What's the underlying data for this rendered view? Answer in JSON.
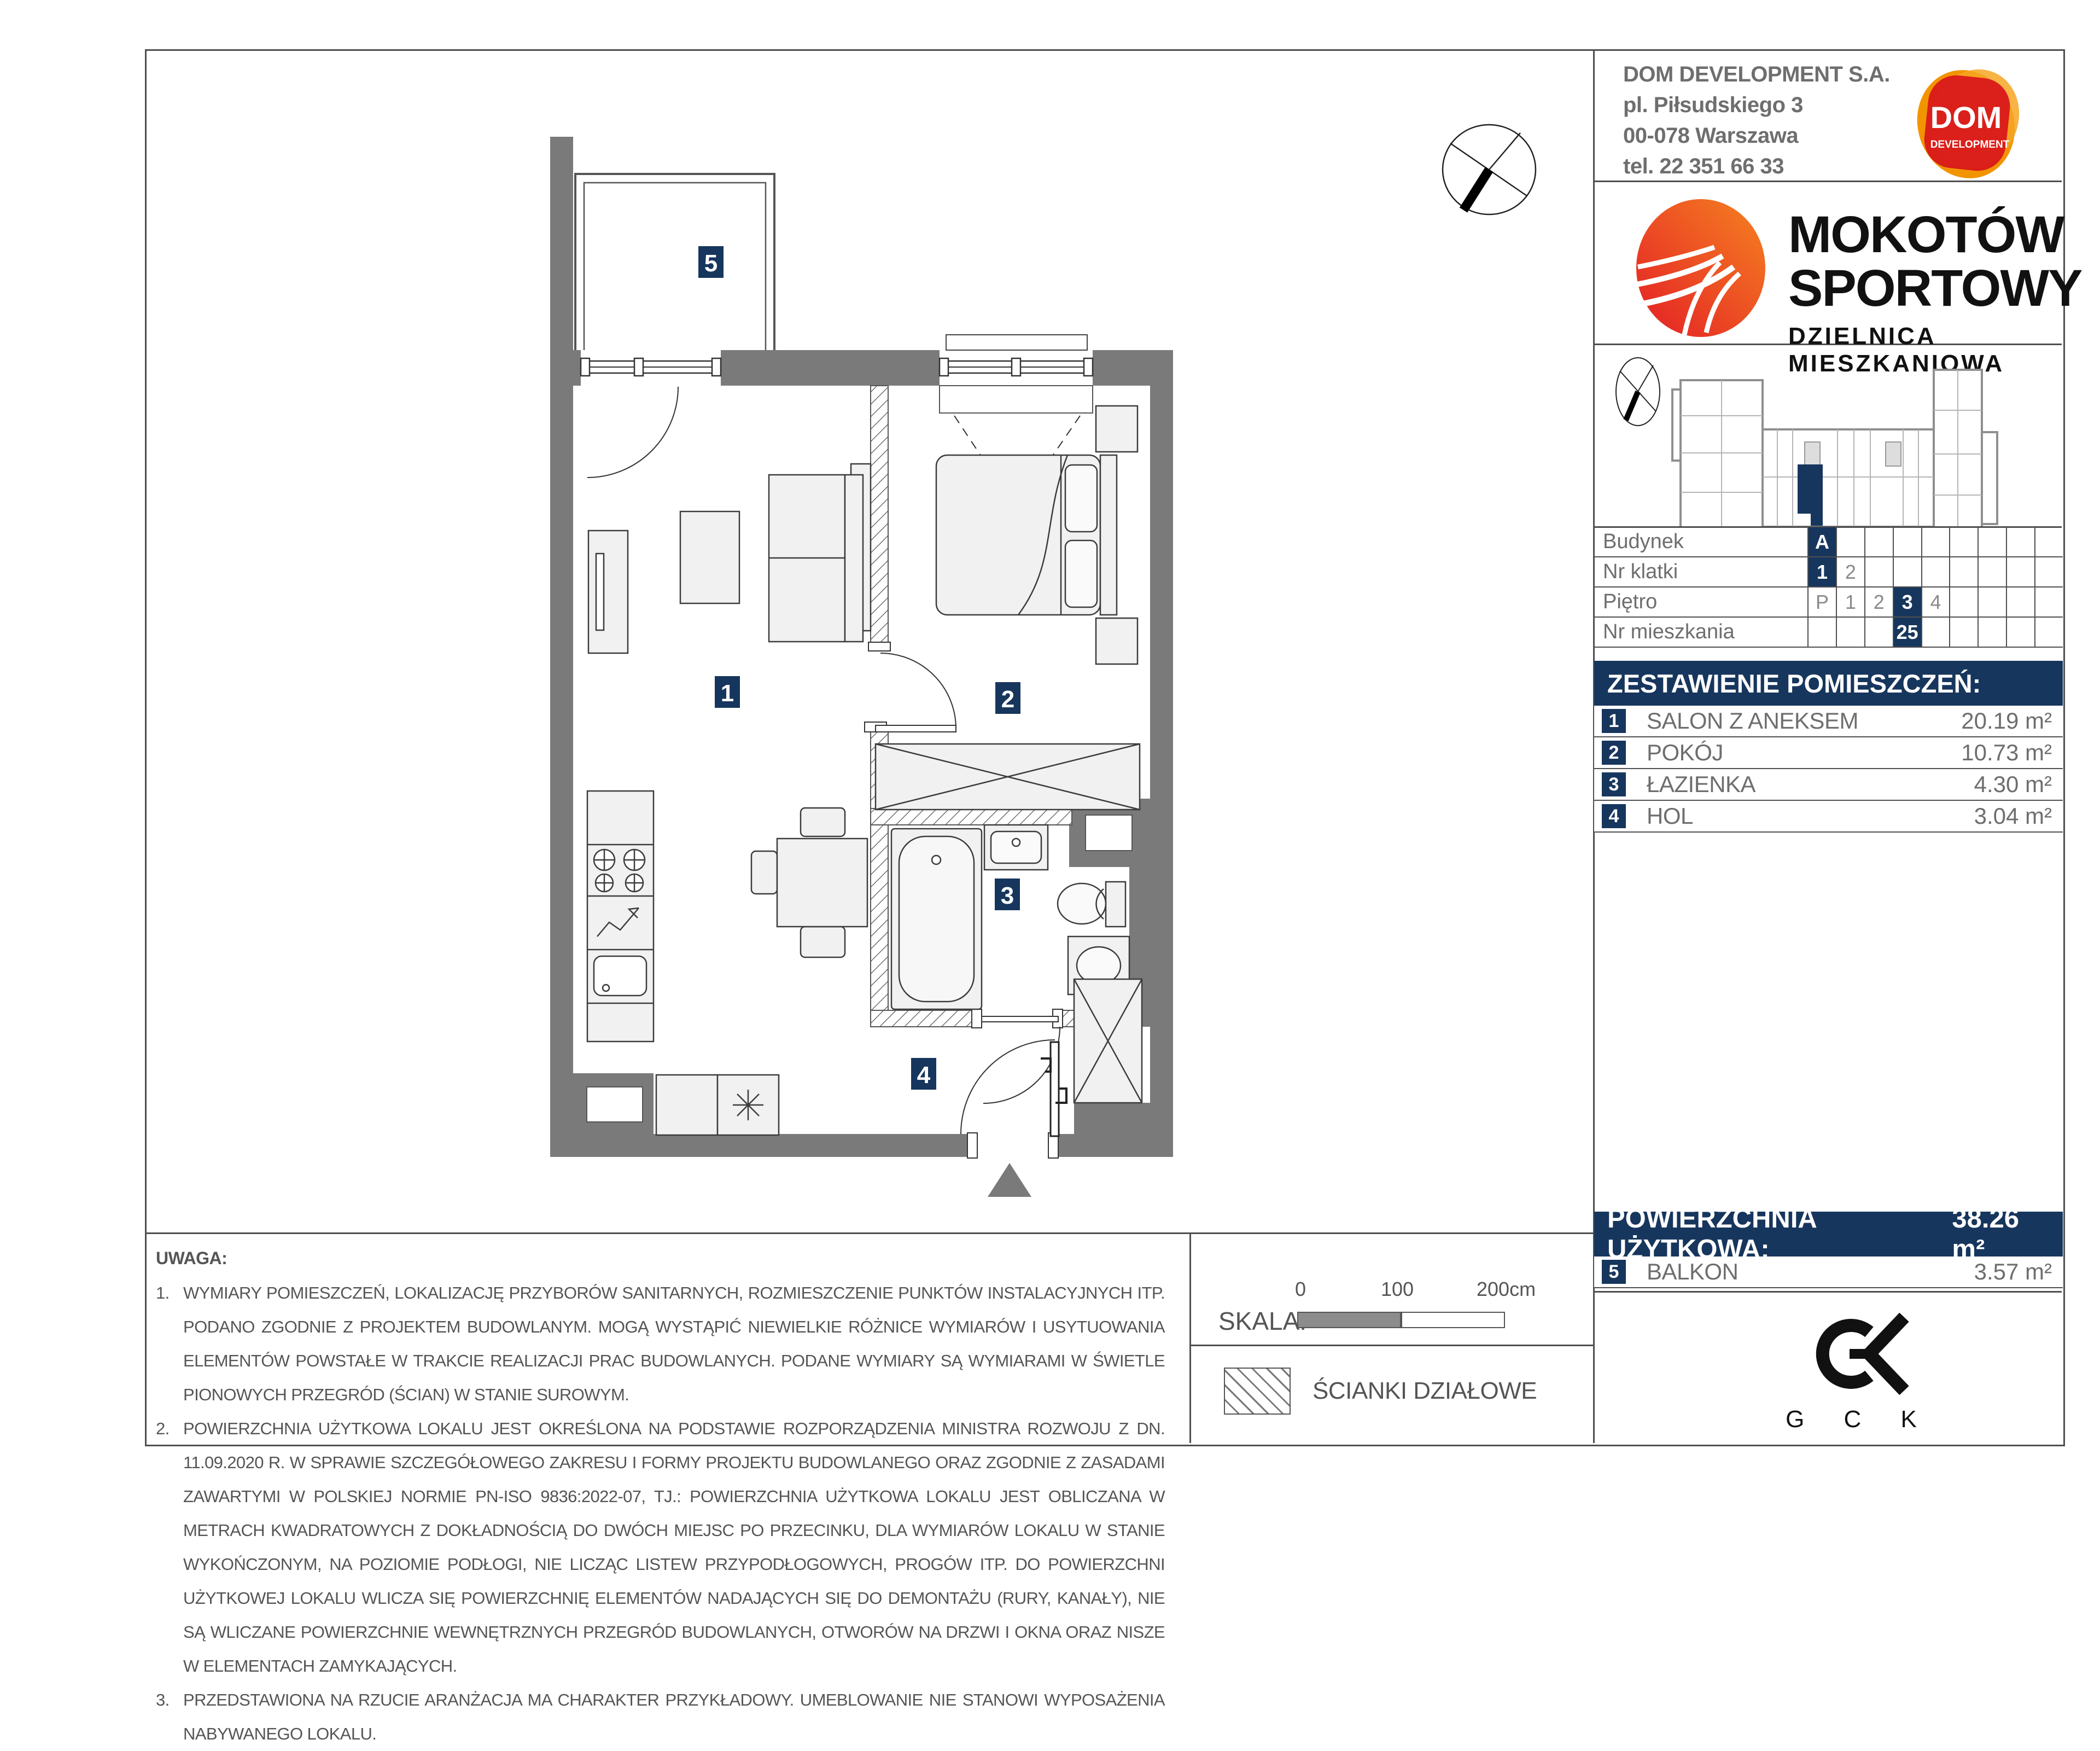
{
  "colors": {
    "navy": "#17365d",
    "wall_gray": "#7a7a7a",
    "brand_red": "#e8301e",
    "brand_orange": "#f29400"
  },
  "developer": {
    "name": "DOM DEVELOPMENT S.A.",
    "address1": "pl. Piłsudskiego 3",
    "address2": "00-078 Warszawa",
    "phone": "tel. 22 351 66 33",
    "logo_main": "DOM",
    "logo_sub": "DEVELOPMENT"
  },
  "project": {
    "title1": "MOKOTÓW",
    "title2": "SPORTOWY",
    "subtitle": "DZIELNICA MIESZKANIOWA"
  },
  "location": {
    "rows": [
      {
        "label": "Budynek",
        "cells": [
          "A",
          "",
          "",
          "",
          "",
          "",
          "",
          "",
          ""
        ]
      },
      {
        "label": "Nr klatki",
        "cells": [
          "1",
          "2",
          "",
          "",
          "",
          "",
          "",
          "",
          ""
        ]
      },
      {
        "label": "Piętro",
        "cells": [
          "P",
          "1",
          "2",
          "3",
          "4",
          "",
          "",
          "",
          ""
        ]
      },
      {
        "label": "Nr mieszkania",
        "cells": [
          "",
          "",
          "",
          "25",
          "",
          "",
          "",
          "",
          ""
        ]
      }
    ]
  },
  "rooms": {
    "header": "ZESTAWIENIE POMIESZCZEŃ:",
    "items": [
      {
        "no": "1",
        "name": "SALON Z ANEKSEM",
        "area": "20.19 m²"
      },
      {
        "no": "2",
        "name": "POKÓJ",
        "area": "10.73 m²"
      },
      {
        "no": "3",
        "name": "ŁAZIENKA",
        "area": "4.30 m²"
      },
      {
        "no": "4",
        "name": "HOL",
        "area": "3.04 m²"
      }
    ]
  },
  "summary": {
    "label": "POWIERZCHNIA UŻYTKOWA:",
    "value": "38.26 m²"
  },
  "balcony": {
    "no": "5",
    "name": "BALKON",
    "area": "3.57 m²"
  },
  "plan": {
    "badge1": "1",
    "badge2": "2",
    "badge3": "3",
    "badge4": "4",
    "badge5": "5"
  },
  "scalebar": {
    "label": "SKALA:",
    "tick0": "0",
    "tick100": "100",
    "tick200": "200cm"
  },
  "legend": {
    "partition_label": "ŚCIANKI DZIAŁOWE"
  },
  "notes": {
    "title": "UWAGA:",
    "items": [
      {
        "num": "1.",
        "text": "WYMIARY POMIESZCZEŃ, LOKALIZACJĘ PRZYBORÓW SANITARNYCH, ROZMIESZCZENIE PUNKTÓW INSTALACYJNYCH ITP. PODANO ZGODNIE Z PROJEKTEM BUDOWLANYM. MOGĄ WYSTĄPIĆ NIEWIELKIE RÓŻNICE WYMIARÓW I USYTUOWANIA ELEMENTÓW POWSTAŁE W TRAKCIE REALIZACJI PRAC BUDOWLANYCH. PODANE WYMIARY SĄ WYMIARAMI W ŚWIETLE PIONOWYCH PRZEGRÓD (ŚCIAN) W STANIE SUROWYM."
      },
      {
        "num": "2.",
        "text": "POWIERZCHNIA UŻYTKOWA LOKALU JEST OKREŚLONA NA PODSTAWIE ROZPORZĄDZENIA MINISTRA ROZWOJU Z DN. 11.09.2020 R. W SPRAWIE SZCZEGÓŁOWEGO ZAKRESU I FORMY PROJEKTU BUDOWLANEGO ORAZ ZGODNIE Z ZASADAMI ZAWARTYMI W POLSKIEJ NORMIE PN-ISO 9836:2022-07, TJ.: POWIERZCHNIA UŻYTKOWA LOKALU JEST OBLICZANA W METRACH KWADRATOWYCH Z DOKŁADNOŚCIĄ DO DWÓCH MIEJSC PO PRZECINKU, DLA WYMIARÓW LOKALU W STANIE WYKOŃCZONYM, NA POZIOMIE PODŁOGI, NIE LICZĄC LISTEW PRZYPODŁOGOWYCH, PROGÓW ITP. DO POWIERZCHNI UŻYTKOWEJ LOKALU WLICZA SIĘ POWIERZCHNIĘ ELEMENTÓW NADAJĄCYCH SIĘ DO DEMONTAŻU (RURY, KANAŁY), NIE SĄ WLICZANE POWIERZCHNIE WEWNĘTRZNYCH PRZEGRÓD BUDOWLANYCH, OTWORÓW NA DRZWI I OKNA ORAZ NISZE W ELEMENTACH ZAMYKAJĄCYCH."
      },
      {
        "num": "3.",
        "text": "PRZEDSTAWIONA NA RZUCIE ARANŻACJA MA CHARAKTER PRZYKŁADOWY. UMEBLOWANIE NIE STANOWI WYPOSAŻENIA NABYWANEGO LOKALU."
      }
    ]
  },
  "gck": {
    "letters": "G C K"
  }
}
